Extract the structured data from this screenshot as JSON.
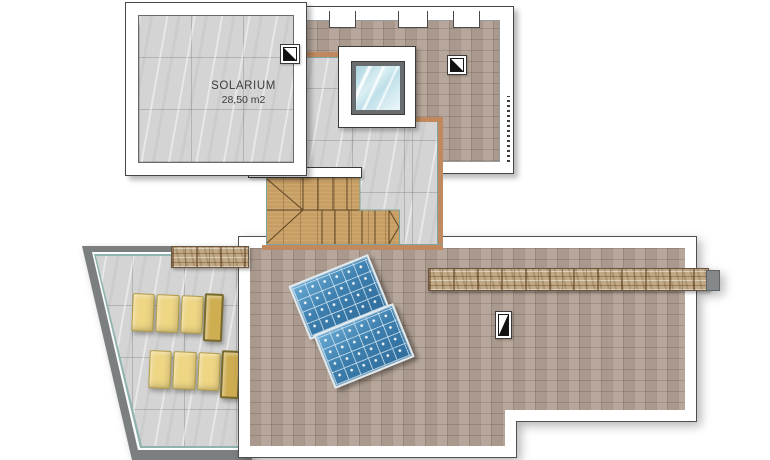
{
  "meta": {
    "type": "architectural-roof-plan",
    "floor": "solarium / roof level"
  },
  "rooms": {
    "solarium": {
      "name": "SOLARIUM",
      "area": "28,50 m2"
    }
  },
  "features": {
    "skylight": "glass skylight over stairwell",
    "stairs": "wooden winder staircase",
    "solar_panels": "2 photovoltaic panels",
    "loungers": "2 sun loungers",
    "drains": "3 roof drain symbols",
    "ledges": "natural stone wall ledges"
  },
  "icons": {
    "drain_solarium": "roof-drain-square",
    "drain_upper_roof": "roof-drain-square",
    "drain_main_roof": "roof-scupper-tall",
    "skylight": "skylight-window",
    "solar_panel": "solar-panel",
    "lounger": "sun-lounger"
  },
  "colors": {
    "background": "#ffffff",
    "solarium_tile": "#d4d4d4",
    "roof_tile": "#b2a195",
    "wood_stair": "#c79e63",
    "stair_border_tan": "#c08a5e",
    "stair_inner_teal": "#7fa6a1",
    "terrace_wall_gray": "#7b7f80",
    "lounger_yellow": "#eed685",
    "solar_panel_blue": "#3d7fae",
    "glass_blue": "#cfe8ee",
    "stone_ledge": "#c2a985",
    "outline": "#474747"
  }
}
